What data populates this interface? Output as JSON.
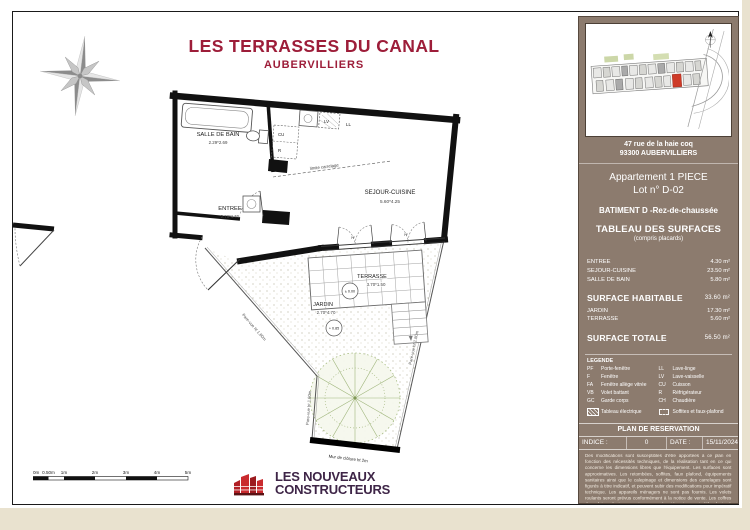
{
  "page": {
    "title": "LES TERRASSES DU CANAL",
    "subtitle": "AUBERVILLIERS"
  },
  "colors": {
    "title_red": "#9d1d39",
    "sidebar_brown": "#8c7b6e",
    "page_cream": "#e9e2cf",
    "lot_red": "#ce3a27",
    "logo_red": "#c92a2e",
    "logo_purple": "#3e2547"
  },
  "sidebar": {
    "map": {
      "caption_line1": "47 rue de la haie coq",
      "caption_line2": "93300 AUBERVILLIERS"
    },
    "apartment": {
      "line1": "Appartement  1 PIECE",
      "line2": "Lot n° D-02",
      "building": "BATIMENT D -Rez-de-chaussée",
      "table_title": "TABLEAU DES SURFACES",
      "table_subtitle": "(compris placards)"
    },
    "surfaces": {
      "rows": [
        {
          "label": "ENTREE",
          "value": "4.30 m²"
        },
        {
          "label": "SEJOUR-CUISINE",
          "value": "23.50 m²"
        },
        {
          "label": "SALLE DE BAIN",
          "value": "5.80 m²"
        }
      ],
      "habitable": {
        "label": "SURFACE HABITABLE",
        "value": "33.60 m²"
      },
      "exterior_rows": [
        {
          "label": "JARDIN",
          "value": "17.30 m²"
        },
        {
          "label": "TERRASSE",
          "value": "5.60 m²"
        }
      ],
      "totale": {
        "label": "SURFACE TOTALE",
        "value": "56.50 m²"
      }
    },
    "legend": {
      "title": "LEGENDE",
      "left": [
        [
          "PF",
          "Porte-fenêtre"
        ],
        [
          "F",
          "Fenêtre"
        ],
        [
          "FA",
          "Fenêtre allège vitrée"
        ],
        [
          "VB",
          "Volet battant"
        ],
        [
          "GC",
          "Garde corps"
        ]
      ],
      "right": [
        [
          "LL",
          "Lave-linge"
        ],
        [
          "LV",
          "Lave-vaisselle"
        ],
        [
          "CU",
          "Cuisson"
        ],
        [
          "R",
          "Réfrigérateur"
        ],
        [
          "CH",
          "Chaudière"
        ]
      ],
      "electrical": "Tableau électrique",
      "soffits": "Soffites et faux-plafond"
    },
    "reservation": {
      "title": "PLAN DE RESERVATION",
      "indice_label": "INDICE :",
      "indice_value": "0",
      "date_label": "DATE :",
      "date_value": "15/11/2024"
    },
    "disclaimer": "Des modifications sont susceptibles d'être apportées à ce plan en fonction des nécessités techniques, de la réalisation tant en ce qui concerne les dimensions libres que l'équipement. Les surfaces sont approximatives. Les retombées, soffites, faux plafond, équipements sanitaires ainsi que le calepinage et dimensions des carrelages sont figurés à titre indicatif, et peuvent subir des modifications pour impératif technique. Les appareils ménagers ne sont pas fournis. Les volets roulants seront prévus conformément à la notice de vente. Les coffres de volet roulant ne sont pas représentés et seront débordants à l'intérieur. La hauteur des seuils au droit des porte-fenêtres sur balcons ou terrasses pourra varier de 5 à 35 cm à partir du sol extérieur. La hauteur entre le jardin et la terrasse pourra varier entre 0 et 60 cm. Les jardins ne seront pas nécessairement plats et pourront comporter des talus et des pentes."
  },
  "plan": {
    "rooms": {
      "salle_de_bain": {
        "name": "SALLE DE BAIN",
        "dims": "2.29*2.69"
      },
      "entree": {
        "name": "ENTREE",
        "dims": "2.70*1.55"
      },
      "sejour": {
        "name": "SEJOUR-CUISINE",
        "dims": "5.60*4.25"
      },
      "terrasse": {
        "name": "TERRASSE",
        "dims": "3.70*1.50",
        "level": "± 0.00"
      },
      "jardin": {
        "name": "JARDIN",
        "dims": "2.70*4.70",
        "level": "+ 0.85"
      }
    },
    "labels": {
      "lv": "LV",
      "ll": "LL",
      "cu": "CU",
      "r": "R",
      "pf": "PF",
      "limite": "limite carrelage",
      "pare_vue": "Pare-vue ht 1.80m",
      "mur": "Mur de clôture ht 2m"
    }
  },
  "scalebar": {
    "labels": [
      "0m",
      "0.50m",
      "1m",
      "2m",
      "3m",
      "4m",
      "5m"
    ]
  },
  "logo": {
    "line1": "LES NOUVEAUX",
    "line2": "CONSTRUCTEURS"
  }
}
